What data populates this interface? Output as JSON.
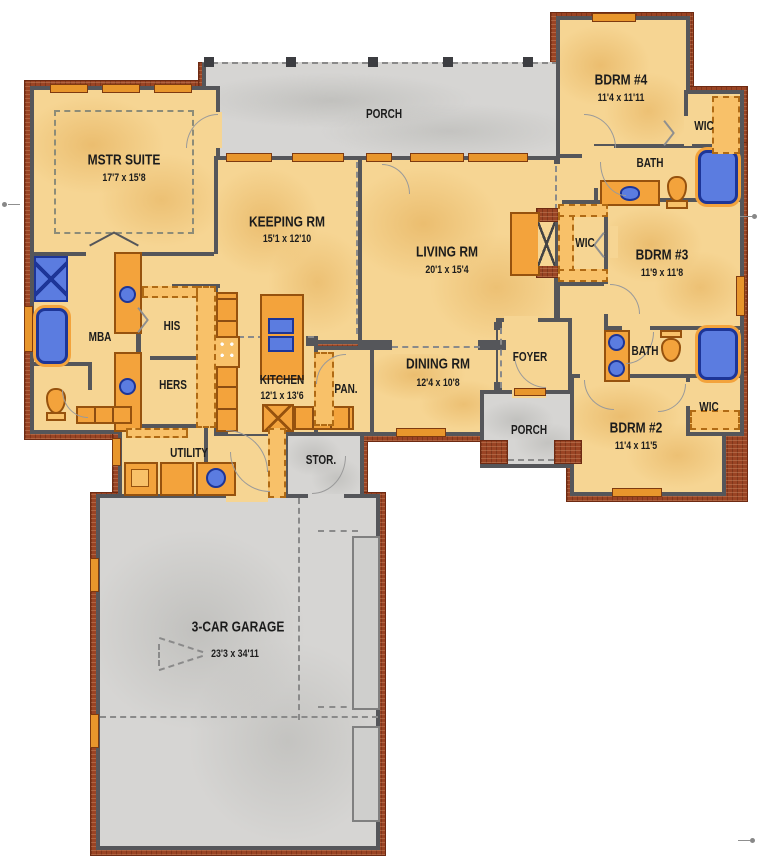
{
  "title": "House floor plan",
  "rooms": {
    "mstr": {
      "name": "MSTR SUITE",
      "dims": "17'7 x 15'8"
    },
    "keeping": {
      "name": "KEEPING RM",
      "dims": "15'1 x 12'10"
    },
    "living": {
      "name": "LIVING RM",
      "dims": "20'1 x 15'4"
    },
    "dining": {
      "name": "DINING RM",
      "dims": "12'4 x 10'8"
    },
    "kitchen": {
      "name": "KITCHEN",
      "dims": "12'1 x 13'6"
    },
    "pantry": {
      "name": "PAN."
    },
    "foyer": {
      "name": "FOYER"
    },
    "porch_rear": {
      "name": "PORCH"
    },
    "porch_front": {
      "name": "PORCH"
    },
    "bdrm4": {
      "name": "BDRM #4",
      "dims": "11'4 x 11'11"
    },
    "bdrm3": {
      "name": "BDRM #3",
      "dims": "11'9 x 11'8"
    },
    "bdrm2": {
      "name": "BDRM #2",
      "dims": "11'4 x 11'5"
    },
    "bath_upper": {
      "name": "BATH"
    },
    "bath_lower": {
      "name": "BATH"
    },
    "wic_upper": {
      "name": "WIC"
    },
    "wic_mid": {
      "name": "WIC"
    },
    "wic_lower": {
      "name": "WIC"
    },
    "mba": {
      "name": "MBA"
    },
    "his": {
      "name": "HIS"
    },
    "hers": {
      "name": "HERS"
    },
    "utility": {
      "name": "UTILITY"
    },
    "storage": {
      "name": "STOR."
    },
    "garage": {
      "name": "3-CAR GARAGE",
      "dims": "23'3 x 34'11"
    }
  },
  "colors": {
    "wall": "#55565a",
    "brick": "#9a4424",
    "room_fill": "#f6d593",
    "room_texture": "#e0a64c",
    "floor_gray": "#d6d5d3",
    "cabinet_orange": "#f3a33c",
    "cabinet_light": "#f8c169",
    "fixture_blue": "#5b7ce0",
    "fixture_navy": "#1d3597",
    "label_text": "#1c1c1c"
  }
}
